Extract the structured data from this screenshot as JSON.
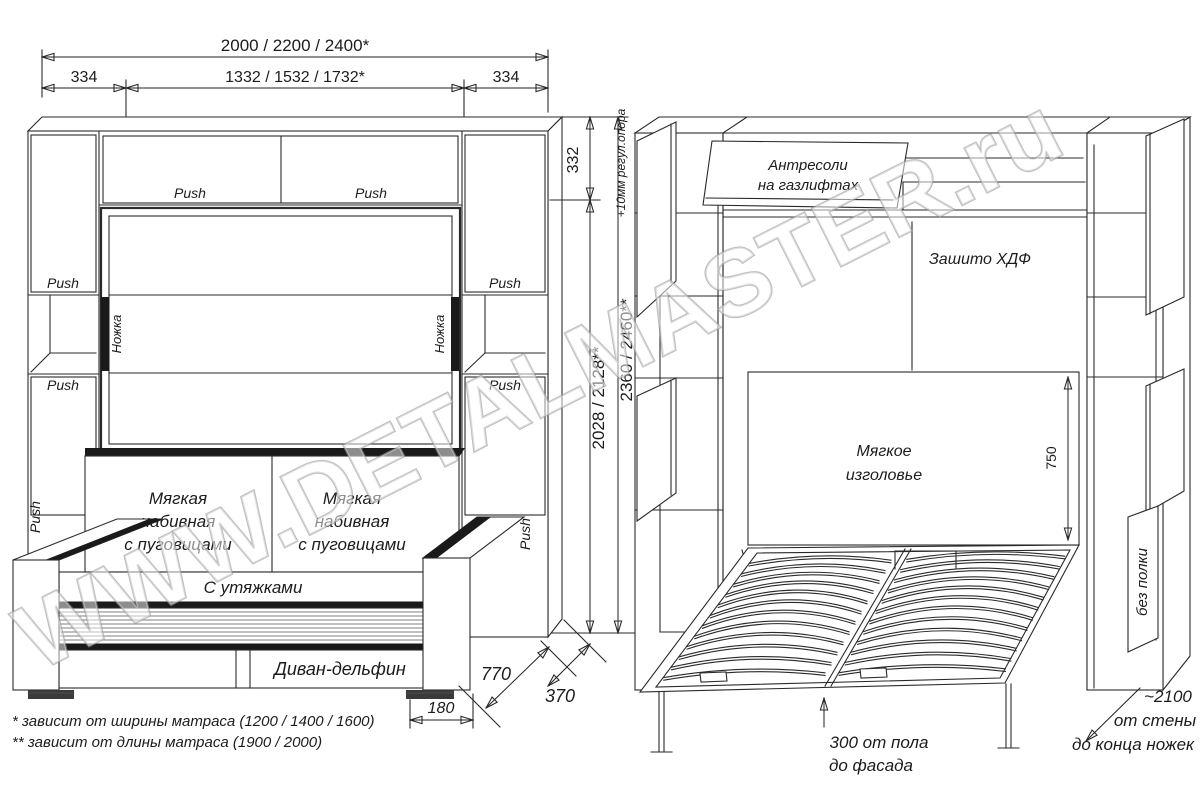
{
  "watermark": "WWW.DETALMASTER.ru",
  "colors": {
    "line": "#2a2a2a",
    "accent_dark": "#1a1a1a",
    "watermark_gray": "#979797",
    "background": "#ffffff"
  },
  "footnotes": {
    "line1": "* зависит от ширины матраса (1200 / 1400 / 1600)",
    "line2": "** зависит от длины матраса (1900 / 2000)"
  },
  "closed_view": {
    "dim_total_width": "2000 / 2200 / 2400*",
    "dim_side_left": "334",
    "dim_inner_width": "1332 / 1532 / 1732*",
    "dim_side_right": "334",
    "dim_top_section": "332",
    "dim_inner_height": "2028 / 2128**",
    "dim_total_height": "2360 / 2460**",
    "dim_height_note": "+10мм регул.опора",
    "dim_sofa_depth": "770",
    "dim_back_depth": "370",
    "dim_foot_inset": "180",
    "push": "Push",
    "leg_label": "Ножка",
    "cushion_line1": "Мягкая",
    "cushion_line2": "набивная",
    "cushion_line3": "с пуговицами",
    "seat_label": "С утяжками",
    "base_label": "Диван-дельфин"
  },
  "open_view": {
    "antresol_line1": "Антресоли",
    "antresol_line2": "на газлифтах",
    "back_panel": "Зашито ХДФ",
    "headboard_line1": "Мягкое",
    "headboard_line2": "изголовье",
    "dim_headboard": "750",
    "floor_line1": "300 от пола",
    "floor_line2": "до фасада",
    "wall_line1": "~2100",
    "wall_line2": "от стены",
    "wall_line3": "до конца ножек",
    "no_shelf": "без полки"
  }
}
